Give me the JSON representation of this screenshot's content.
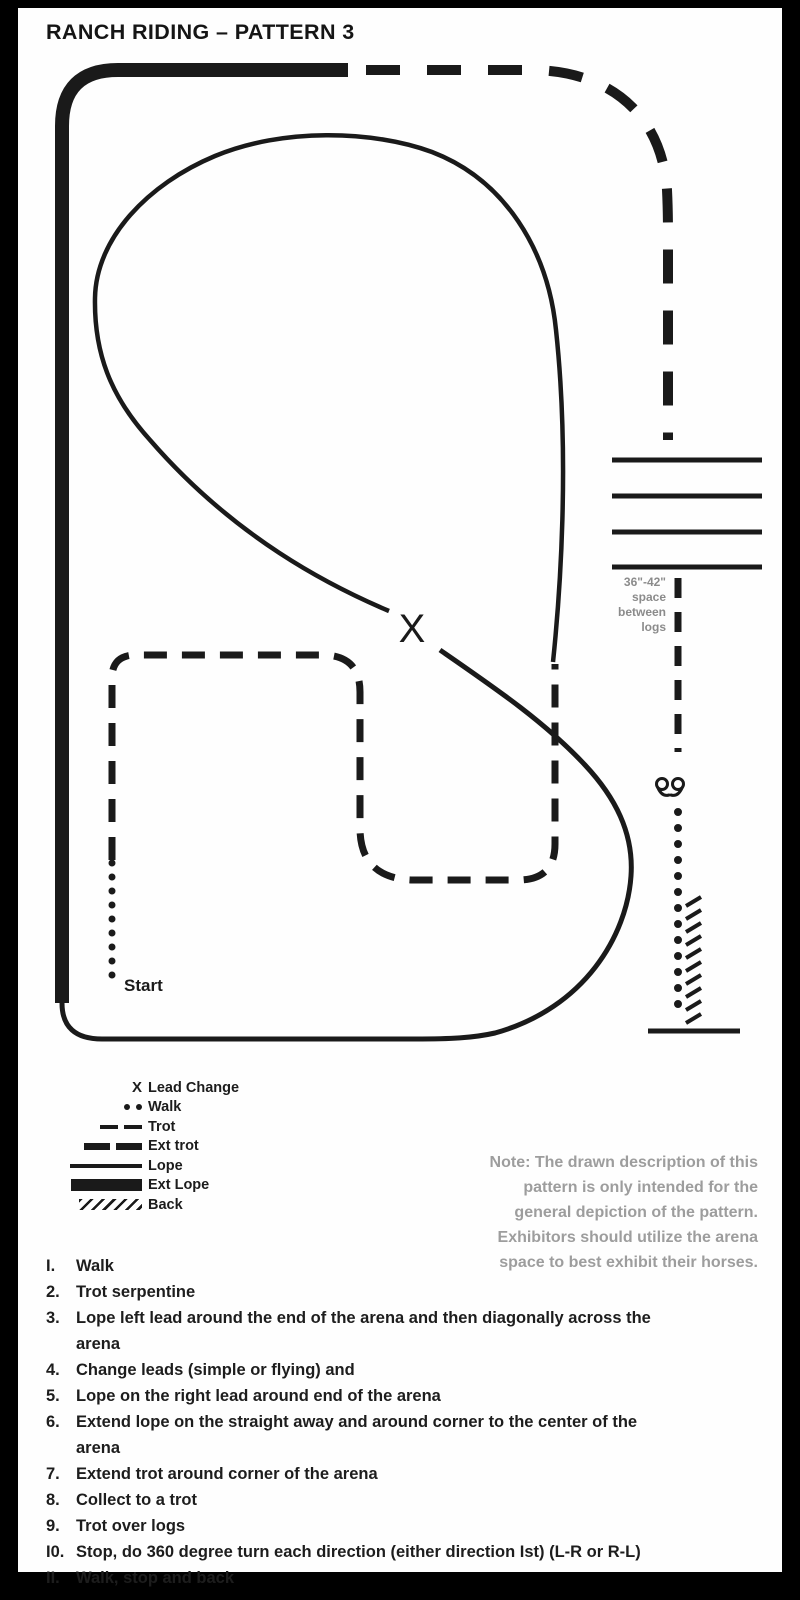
{
  "title": "RANCH RIDING – PATTERN 3",
  "diagram": {
    "lead_change_marker": "X",
    "start_label": "Start",
    "logs_note": {
      "lines": [
        "36\"-42\"",
        "space",
        "between",
        "logs"
      ]
    }
  },
  "legend": {
    "x_symbol": "X",
    "items": [
      {
        "symbol": "x-marker",
        "label": "Lead Change"
      },
      {
        "symbol": "dots",
        "label": "Walk"
      },
      {
        "symbol": "dash-thin",
        "label": "Trot"
      },
      {
        "symbol": "dash-thick",
        "label": "Ext trot"
      },
      {
        "symbol": "line-thin",
        "label": "Lope"
      },
      {
        "symbol": "line-thick",
        "label": "Ext Lope"
      },
      {
        "symbol": "hatch",
        "label": "Back"
      }
    ]
  },
  "note": {
    "lines": [
      "Note: The drawn description of this",
      "pattern is only intended for the",
      "general depiction of the pattern.",
      "Exhibitors should utilize the arena",
      "space to best exhibit their horses."
    ]
  },
  "instructions": {
    "items": [
      {
        "num": "I.",
        "text": "Walk"
      },
      {
        "num": "2.",
        "text": "Trot serpentine"
      },
      {
        "num": "3.",
        "text": "Lope left lead around the end of the arena and then diagonally across the\narena"
      },
      {
        "num": "4.",
        "text": "Change leads (simple or flying) and"
      },
      {
        "num": "5.",
        "text": "Lope on the right lead around end of the arena"
      },
      {
        "num": "6.",
        "text": "Extend lope on the straight away and around corner to the center of the\narena"
      },
      {
        "num": "7.",
        "text": "Extend trot around corner of the arena"
      },
      {
        "num": "8.",
        "text": "Collect to a trot"
      },
      {
        "num": "9.",
        "text": "Trot over logs"
      },
      {
        "num": "I0.",
        "text": "Stop, do 360 degree turn each direction (either direction Ist)  (L-R or R-L)"
      },
      {
        "num": "II.",
        "text": "Walk, stop and back"
      }
    ]
  },
  "colors": {
    "ink": "#1a1a1a",
    "muted_text": "#9d9d9d",
    "logs_label": "#8b8b8b"
  }
}
